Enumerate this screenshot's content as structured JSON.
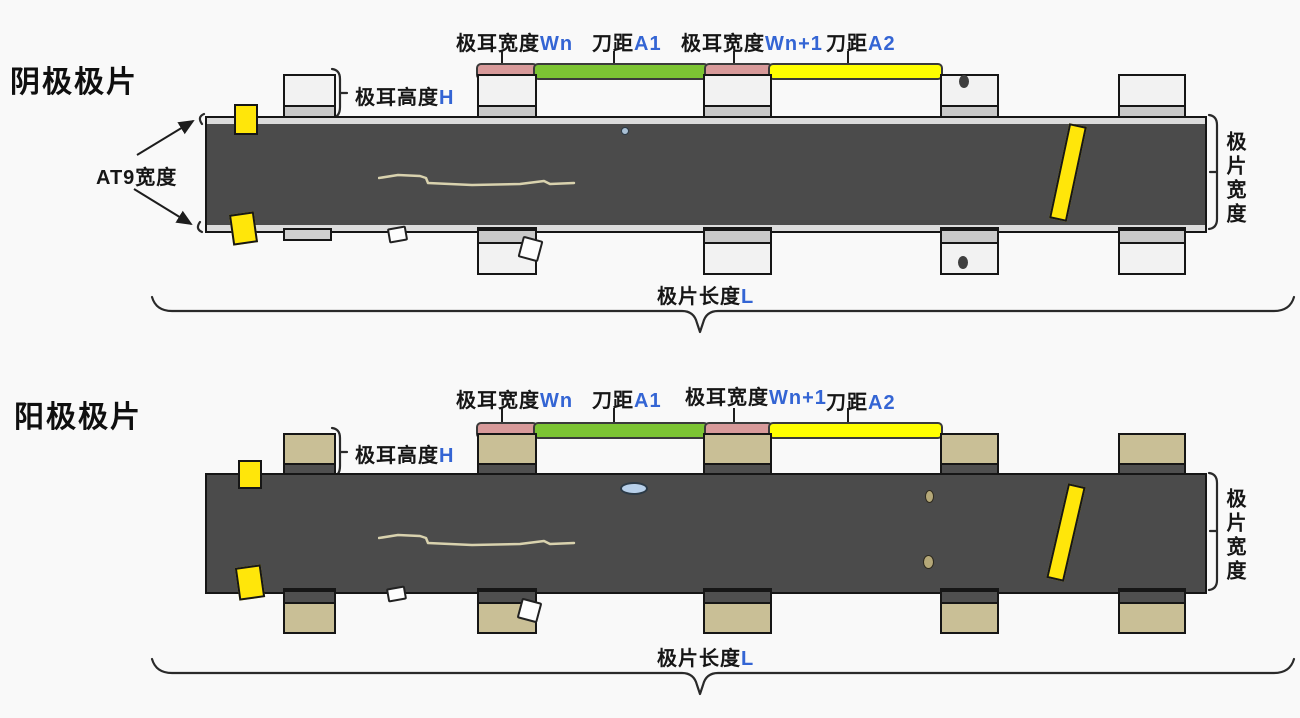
{
  "colors": {
    "background": "#f9f9f9",
    "electrode_strip": "#4b4b4b",
    "foil_edge_band": "#dcdcdc",
    "cathode_tab": "#f2f2f2",
    "cathode_tab_band": "#c9c9c9",
    "anode_tab": "#c9bf96",
    "anode_tab_band": "#4f4f4f",
    "tab_width_bar": "#d89a9a",
    "knife_gap_a1_bar": "#7cc433",
    "knife_gap_a2_bar": "#ffff00",
    "yellow_tape_marker": "#ffe60a",
    "variable_text_blue": "#3465d4",
    "blue_bubble_defect": "#b8d0ea"
  },
  "diagrams": [
    {
      "id": "cathode",
      "title": "阴极极片",
      "top_dims": [
        {
          "text": "极耳宽度",
          "var": "Wn"
        },
        {
          "text": "刀距",
          "var": "A1"
        },
        {
          "text": "极耳宽度",
          "var": "Wn+1"
        },
        {
          "text": "刀距",
          "var": "A2"
        }
      ],
      "tab_height": {
        "text": "极耳高度",
        "var": "H"
      },
      "at9_label": "AT9宽度",
      "sheet_width_label": "极片宽度",
      "sheet_length": {
        "text": "极片长度",
        "var": "L"
      }
    },
    {
      "id": "anode",
      "title": "阳极极片",
      "top_dims": [
        {
          "text": "极耳宽度",
          "var": "Wn"
        },
        {
          "text": "刀距",
          "var": "A1"
        },
        {
          "text": "极耳宽度",
          "var": "Wn+1"
        },
        {
          "text": "刀距",
          "var": "A2"
        }
      ],
      "tab_height": {
        "text": "极耳高度",
        "var": "H"
      },
      "sheet_width_label": "极片宽度",
      "sheet_length": {
        "text": "极片长度",
        "var": "L"
      }
    }
  ]
}
